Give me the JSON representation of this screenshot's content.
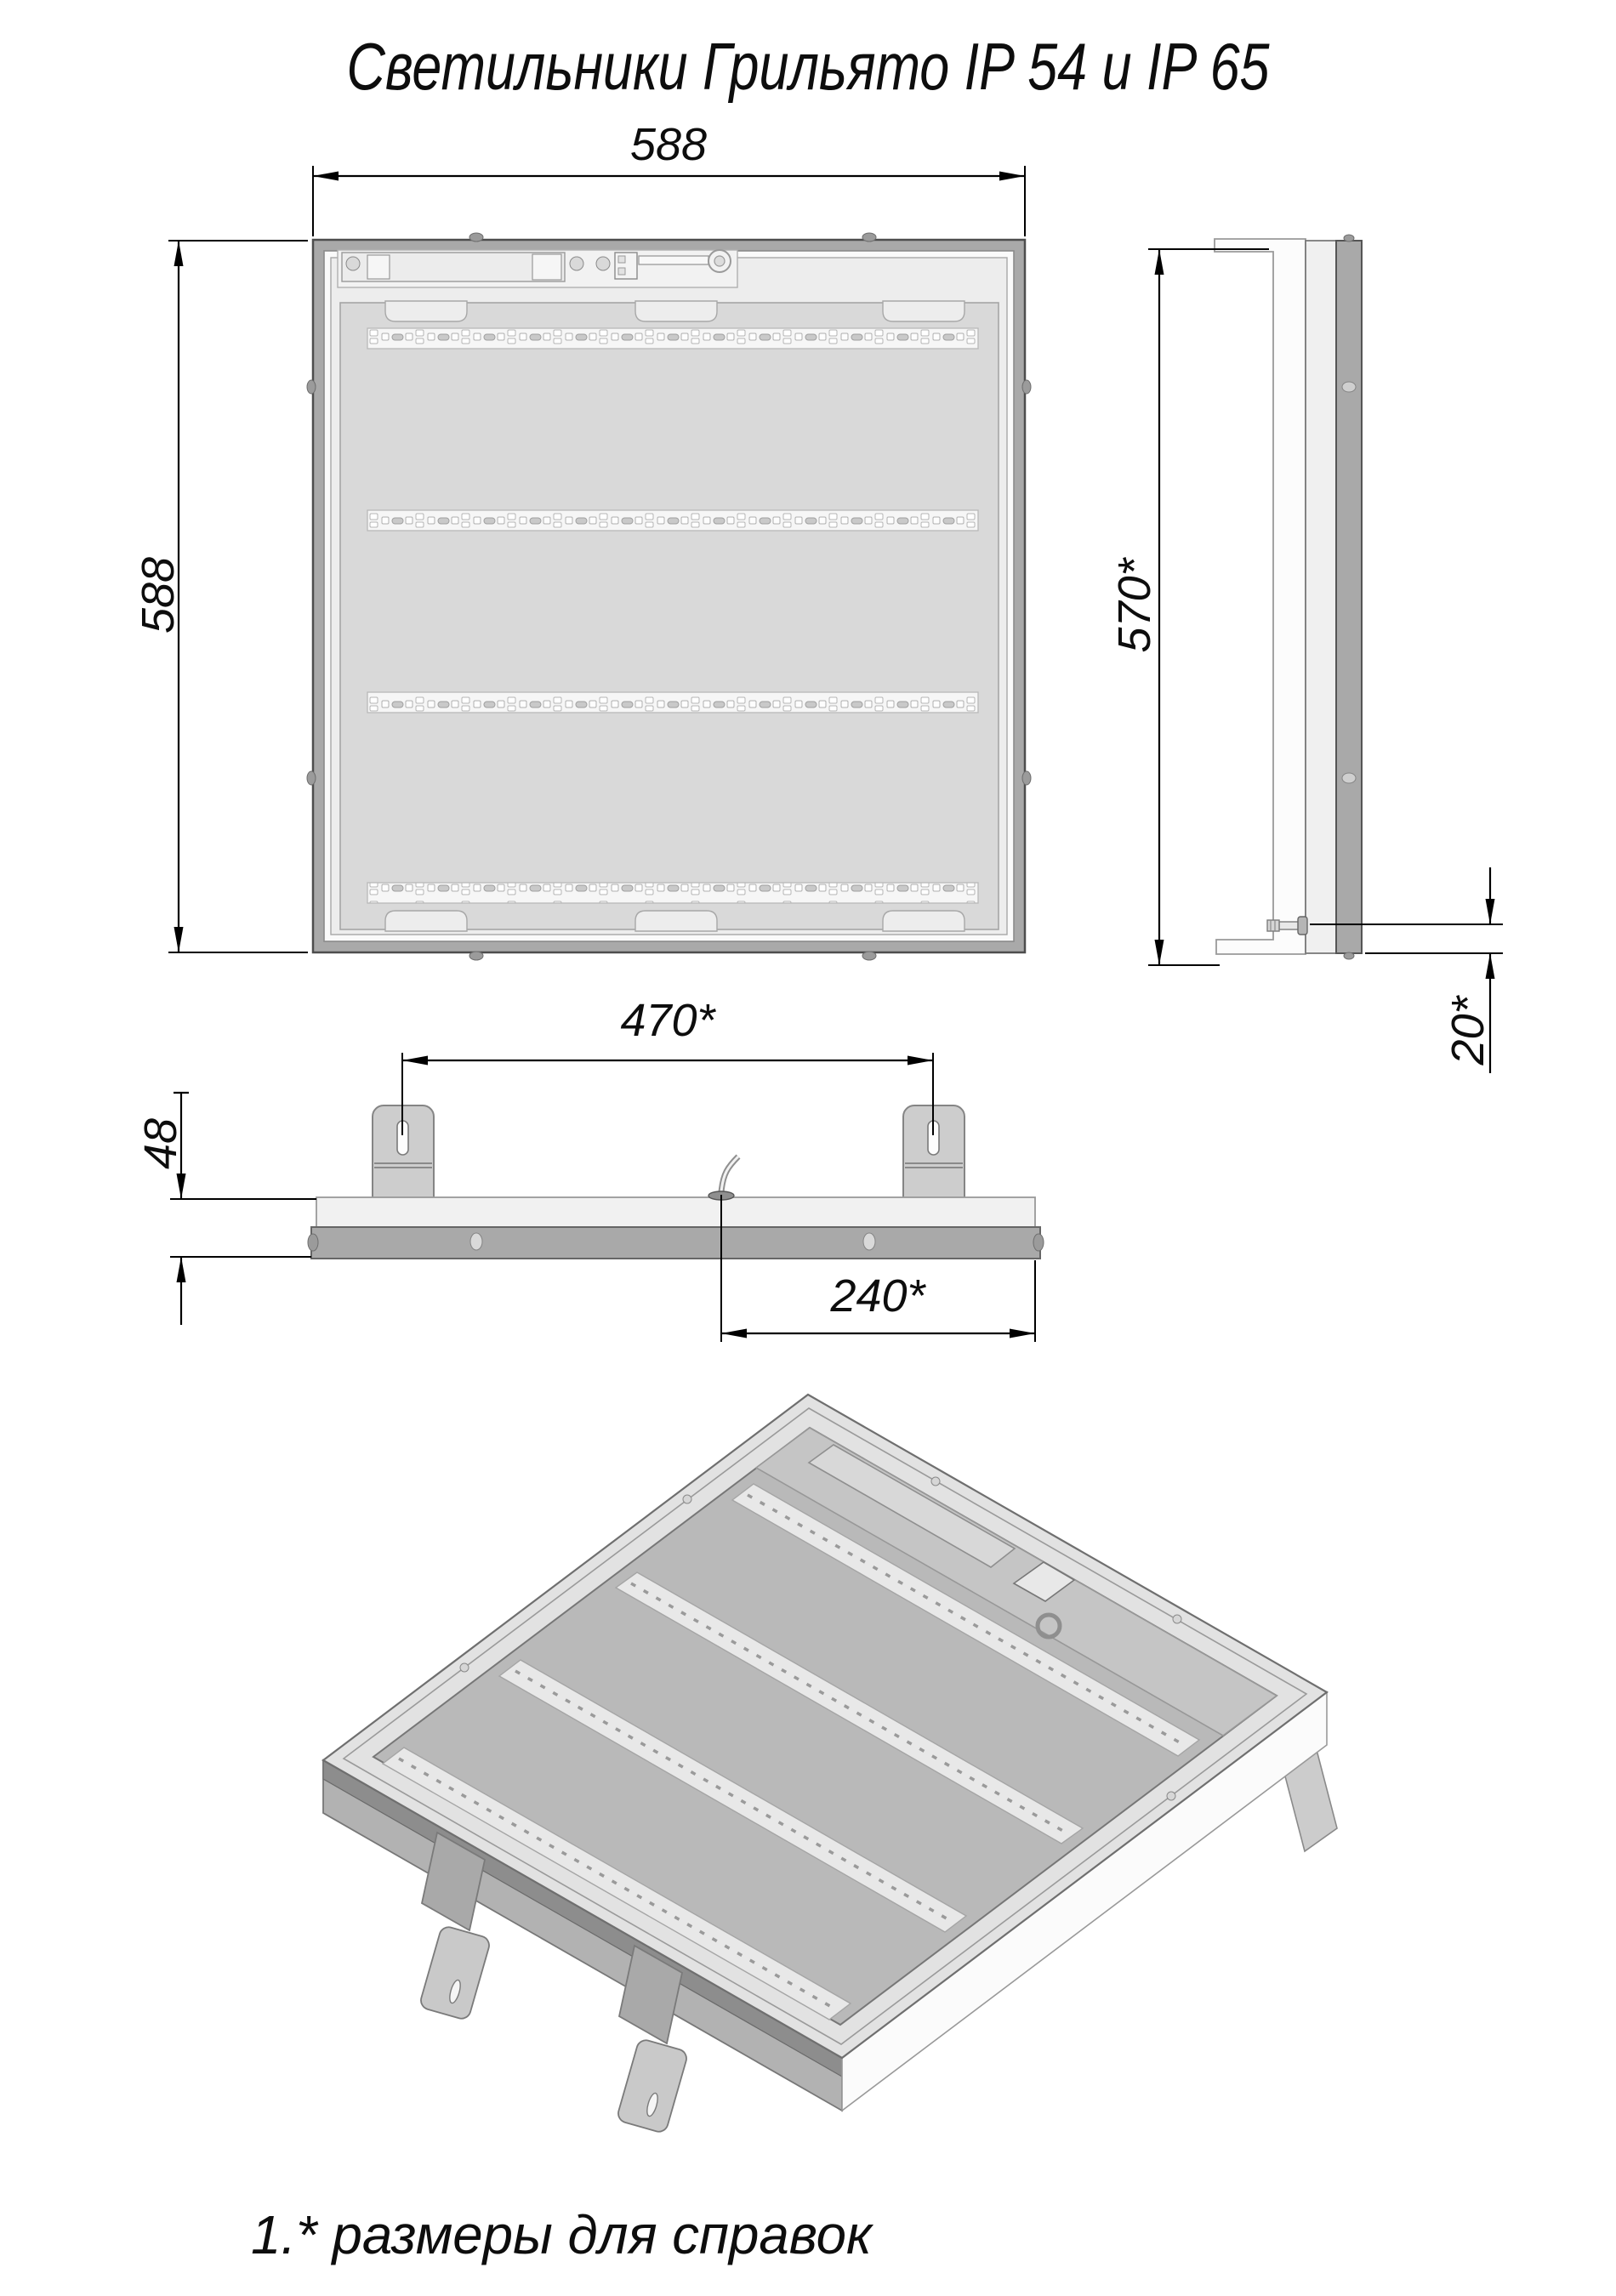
{
  "title": "Светильники Грильято IP 54 и IP 65",
  "note": "1.* размеры для справок",
  "dimensions": {
    "front_width": "588",
    "front_height": "588",
    "side_height": "570*",
    "side_recess": "20*",
    "bracket_spacing": "470*",
    "profile_height": "48",
    "cable_offset": "240*"
  },
  "colors": {
    "frame_gray": "#a9a9a9",
    "panel_light": "#ededed",
    "reflector": "#d9d9d9",
    "line_black": "#000000"
  }
}
